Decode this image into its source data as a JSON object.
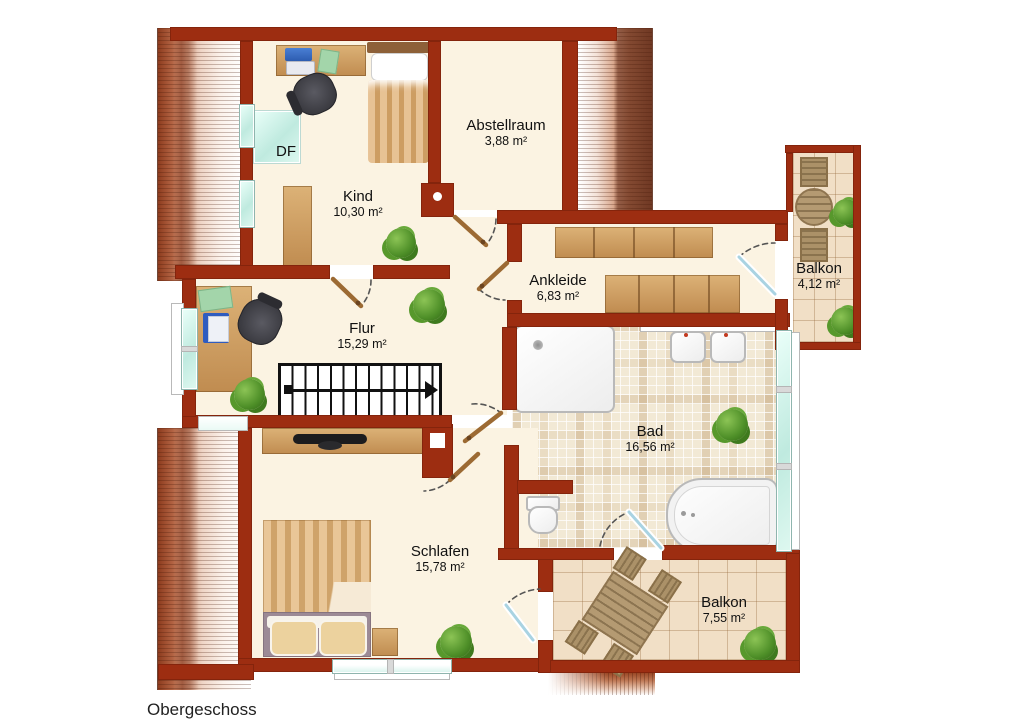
{
  "title": "Obergeschoss",
  "rooms": {
    "kind": {
      "name": "Kind",
      "area": "10,30 m²"
    },
    "abstellraum": {
      "name": "Abstellraum",
      "area": "3,88 m²"
    },
    "ankleide": {
      "name": "Ankleide",
      "area": "6,83 m²"
    },
    "flur": {
      "name": "Flur",
      "area": "15,29 m²"
    },
    "bad": {
      "name": "Bad",
      "area": "16,56 m²"
    },
    "schlafen": {
      "name": "Schlafen",
      "area": "15,78 m²"
    },
    "balkon_top": {
      "name": "Balkon",
      "area": "4,12 m²"
    },
    "balkon_bottom": {
      "name": "Balkon",
      "area": "7,55 m²"
    }
  },
  "annotations": {
    "skylight": "DF"
  },
  "colors": {
    "wall": "#9d2d11",
    "floor": "#fbf3e2",
    "bad_tile": "#f2e9d5",
    "balcony_tile": "#f1dfc6",
    "window": "#d4f2ea",
    "wood": "#c89058",
    "plant": "#55932c"
  }
}
